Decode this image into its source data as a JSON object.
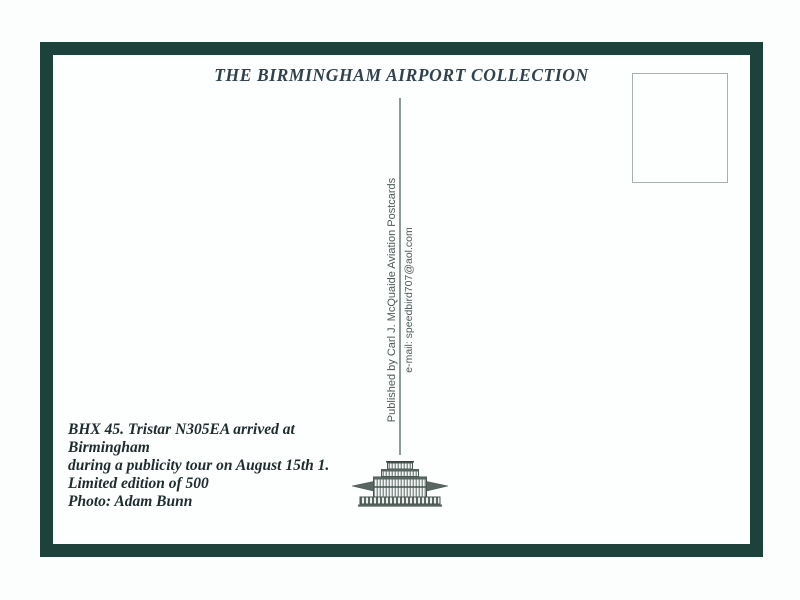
{
  "card": {
    "title": "THE BIRMINGHAM AIRPORT COLLECTION",
    "publisher_line": "Published by Carl J. McQuaide Aviation Postcards",
    "email_line": "e-mail: speedbird707@aol.com",
    "caption": {
      "lines": [
        "BHX 45. Tristar N305EA arrived at",
        "Birmingham",
        "during a publicity tour on August 15th 1.",
        "Limited edition of 500",
        "Photo: Adam Bunn"
      ]
    },
    "stamp_box": {
      "label": ""
    },
    "logo": "airport-terminal-building"
  },
  "colors": {
    "frame_green": "#1d423c",
    "card_white": "#fdfefe",
    "title_text": "#31424d",
    "caption_text": "#1e2c2e",
    "vertical_text": "#4c5a58",
    "divider_line": "#8e9a97",
    "stamp_border": "#a9b1af",
    "logo_ink": "#4c5a56"
  }
}
